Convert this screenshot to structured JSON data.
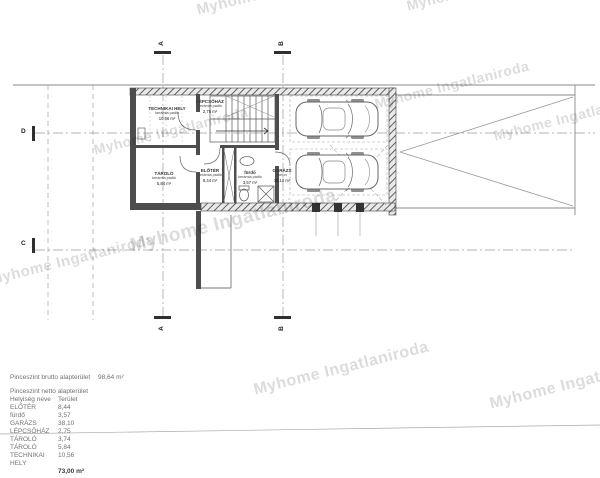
{
  "watermark": {
    "text": "Myhome Ingatlaniroda"
  },
  "markers": {
    "a": "A",
    "b": "B",
    "c": "C",
    "d": "D"
  },
  "rooms": {
    "technikai": {
      "name": "TECHNIKAI HELY",
      "floor": "kerámia padló",
      "area": "10,56 m²"
    },
    "lepcsohaz": {
      "name": "LÉPCSŐHÁZ",
      "floor": "kerámia padló",
      "area": "2,75 m²"
    },
    "tarolo": {
      "name": "TÁROLÓ",
      "floor": "kerámia padló",
      "area": "5,84 m²"
    },
    "eloter": {
      "name": "ELŐTÉR",
      "floor": "kerámia padló",
      "area": "8,44 m²"
    },
    "furdo": {
      "name": "fürdő",
      "floor": "kerámia padló",
      "area": "3,57 m²"
    },
    "garazs": {
      "name": "GARÁZS",
      "floor": "beton",
      "area": "38,10 m²"
    }
  },
  "summary": {
    "gross_label": "Pinceszint brutto alapterület",
    "gross_value": "98,64 m²",
    "net_label": "Pinceszint netto alapterület",
    "col_name": "Helyiség neve",
    "col_area": "Terület",
    "rows": [
      [
        "ELŐTÉR",
        "8,44"
      ],
      [
        "fürdő",
        "3,57"
      ],
      [
        "GARÁZS",
        "38,10"
      ],
      [
        "LÉPCSŐHÁZ",
        "2,75"
      ],
      [
        "TÁROLÓ",
        "3,74"
      ],
      [
        "TÁROLÓ",
        "5,84"
      ],
      [
        "TECHNIKAI HELY",
        "10,56"
      ]
    ],
    "total": "73,00 m²"
  }
}
